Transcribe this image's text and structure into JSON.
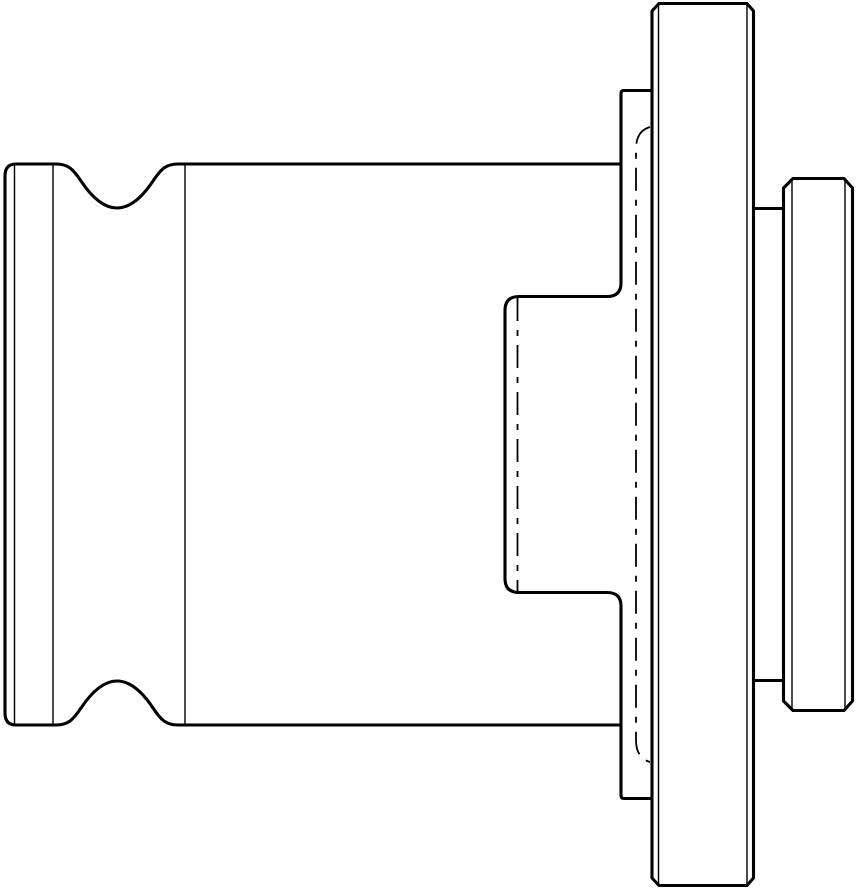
{
  "drawing": {
    "title": "Technical line drawing - quick-change tapping adapter, side view",
    "canvas": {
      "width": 859,
      "height": 889
    },
    "colors": {
      "background": "#ffffff",
      "line": "#000000"
    },
    "stroke": {
      "outline_width": 3.1,
      "thin_width": 1.4,
      "hidden_width": 1.8,
      "hidden_dash": "23 9 6 9"
    },
    "parts": [
      {
        "name": "drive-shank",
        "desc": "left square drive shank with ball groove, x 4-185"
      },
      {
        "name": "ball-groove",
        "desc": "concave groove top and bottom, center x 117, depth 44"
      },
      {
        "name": "body",
        "desc": "main cylindrical body, x 185-621, y 164-725"
      },
      {
        "name": "clutch-pocket",
        "desc": "rear relief pocket, x 505-621, y 296-593"
      },
      {
        "name": "hub",
        "desc": "collar between body and flange, x 621-652, y 90-799"
      },
      {
        "name": "flange",
        "desc": "large chamfered flange disk, x 652-753, y 3-886"
      },
      {
        "name": "pilot",
        "desc": "chamfered pilot nose, x 783-853, y 178-711"
      },
      {
        "name": "hidden-bore",
        "desc": "dashed hidden bore lines at x 636 and x 517"
      }
    ],
    "paths": [
      {
        "name": "body-top-edge",
        "class": "outline",
        "d": "M 16,164 H 56 C 68,164 73,169 81,181 C 91,196 103,208 117,208 C 131,208 143,196 153,181 C 161,169 166,164 178,164 H 621"
      },
      {
        "name": "body-bottom-edge",
        "class": "outline",
        "d": "M 16,725 H 56 C 68,725 73,720 81,708 C 91,693 103,681 117,681 C 131,681 143,693 153,708 C 161,720 166,725 178,725 H 621"
      },
      {
        "name": "shank-left-edge",
        "class": "outline",
        "d": "M 16,164 Q 5,164 5,176 V 713 Q 5,725 16,725"
      },
      {
        "name": "hub-and-pocket-outline",
        "class": "outline",
        "d": "M 652,90.5 H 624 Q 621,90.5 621,93.5 V 283 Q 621,296.5 607,296.5 H 519 Q 505,296.5 505,310.5 V 578.5 Q 505,592.5 519,592.5 H 607 Q 621,592.5 621,606 V 795.5 Q 621,798.5 624,798.5 H 652"
      },
      {
        "name": "flange-outline",
        "class": "outline",
        "d": "M 652,878 V 11 L 659,3.5 H 747 L 753.5,11 V 878 L 747,885.5 H 659 Z"
      },
      {
        "name": "flange-pilot-step-lines",
        "class": "outline",
        "d": "M 753.5,208.5 H 783.5 M 753.5,680.5 H 783.5"
      },
      {
        "name": "pilot-outline",
        "class": "outline",
        "d": "M 783.5,188 L 793,178.5 H 844 L 852.5,188 V 701 L 844,710.5 H 793 L 783.5,701 Z"
      },
      {
        "name": "shank-corner-edge-line-1",
        "class": "thin",
        "d": "M 14.5,165 V 724"
      },
      {
        "name": "shank-corner-edge-line-2",
        "class": "thin",
        "d": "M 53,165 V 724"
      },
      {
        "name": "shank-body-boundary-line",
        "class": "thin",
        "d": "M 185,165 V 724"
      },
      {
        "name": "flange-chamfer-edge-lines",
        "class": "thin",
        "d": "M 658.5,5 V 884 M 747,5 V 884"
      },
      {
        "name": "pilot-chamfer-edge-lines",
        "class": "thin",
        "d": "M 792,180 V 709 M 845,180 V 709"
      },
      {
        "name": "bore-hidden-line",
        "class": "hidden",
        "d": "M 650,127 Q 636,131 636,149 V 740 Q 636,758 650,762"
      },
      {
        "name": "socket-hidden-line",
        "class": "hidden",
        "d": "M 517.5,298 V 591"
      }
    ]
  }
}
